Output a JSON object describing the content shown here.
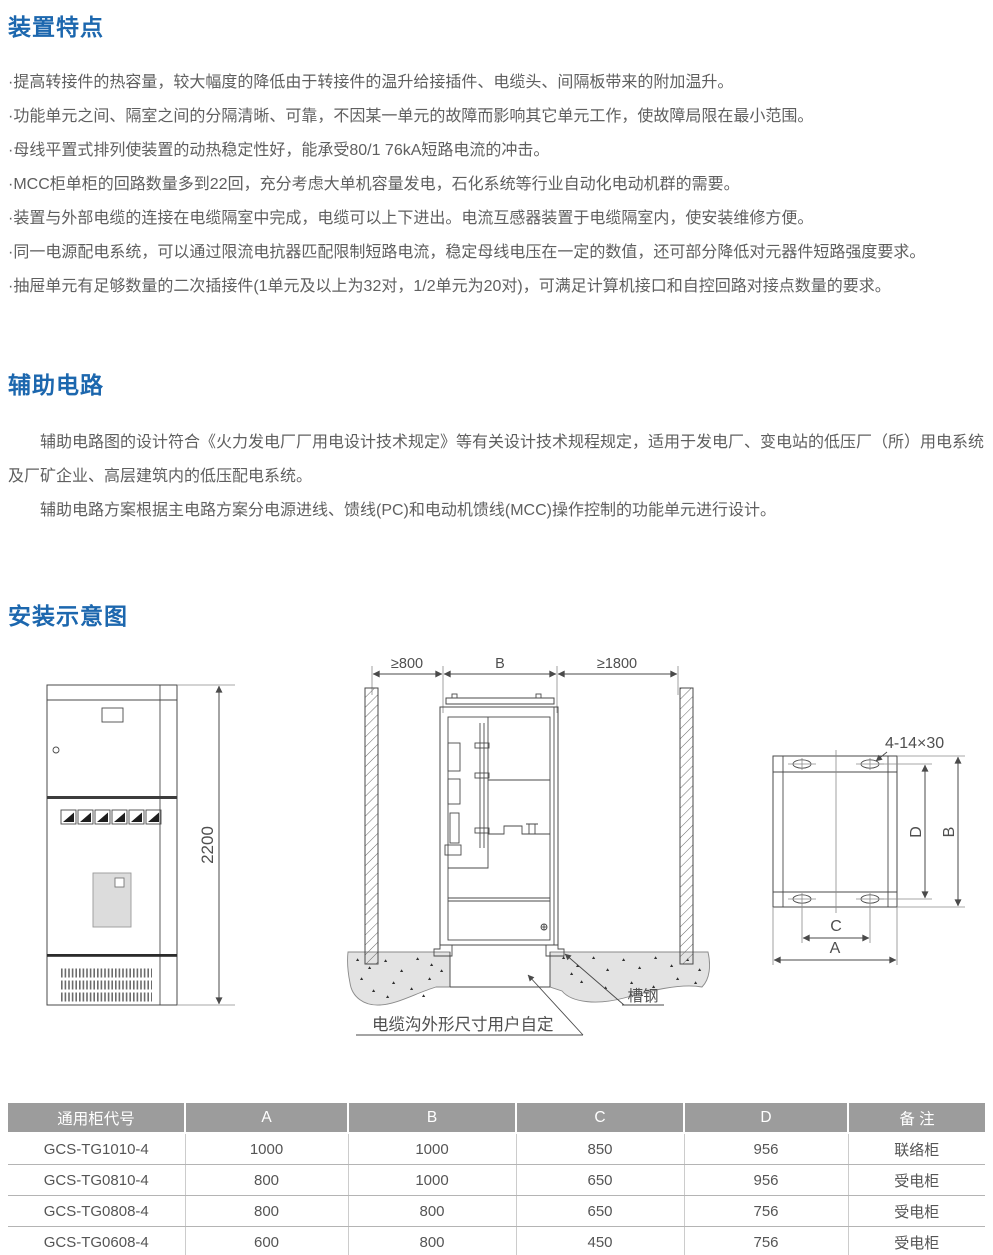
{
  "page": {
    "accent_blue": "#1c67ae",
    "body_text_color": "#5f5f5f",
    "table_header_bg": "#9c9c9c",
    "line_color": "#4a4a4a"
  },
  "sections": {
    "features": {
      "title": "装置特点",
      "items": [
        "·提高转接件的热容量，较大幅度的降低由于转接件的温升给接插件、电缆头、间隔板带来的附加温升。",
        "·功能单元之间、隔室之间的分隔清晰、可靠，不因某一单元的故障而影响其它单元工作，使故障局限在最小范围。",
        "·母线平置式排列使装置的动热稳定性好，能承受80/1 76kA短路电流的冲击。",
        "·MCC柜单柜的回路数量多到22回，充分考虑大单机容量发电，石化系统等行业自动化电动机群的需要。",
        "·装置与外部电缆的连接在电缆隔室中完成，电缆可以上下进出。电流互感器装置于电缆隔室内，使安装维修方便。",
        "·同一电源配电系统，可以通过限流电抗器匹配限制短路电流，稳定母线电压在一定的数值，还可部分降低对元器件短路强度要求。",
        "·抽屉单元有足够数量的二次插接件(1单元及以上为32对，1/2单元为20对)，可满足计算机接口和自控回路对接点数量的要求。"
      ]
    },
    "auxiliary": {
      "title": "辅助电路",
      "paragraphs": [
        "辅助电路图的设计符合《火力发电厂厂用电设计技术规定》等有关设计技术规程规定，适用于发电厂、变电站的低压厂（所）用电系统及厂矿企业、高层建筑内的低压配电系统。",
        "辅助电路方案根据主电路方案分电源进线、馈线(PC)和电动机馈线(MCC)操作控制的功能单元进行设计。"
      ]
    },
    "installation": {
      "title": "安装示意图",
      "front_view": {
        "height_dim": "2200"
      },
      "section_view": {
        "dim_left": "≥800",
        "dim_mid": "B",
        "dim_right": "≥1800",
        "channel_label": "槽钢",
        "trench_label": "电缆沟外形尺寸用户自定"
      },
      "plan_view": {
        "hole_label": "4-14×30",
        "dim_d": "D",
        "dim_b": "B",
        "dim_c": "C",
        "dim_a": "A"
      }
    }
  },
  "table": {
    "headers": [
      "通用柜代号",
      "A",
      "B",
      "C",
      "D",
      "备 注"
    ],
    "rows": [
      [
        "GCS-TG1010-4",
        "1000",
        "1000",
        "850",
        "956",
        "联络柜"
      ],
      [
        "GCS-TG0810-4",
        "800",
        "1000",
        "650",
        "956",
        "受电柜"
      ],
      [
        "GCS-TG0808-4",
        "800",
        "800",
        "650",
        "756",
        "受电柜"
      ],
      [
        "GCS-TG0608-4",
        "600",
        "800",
        "450",
        "756",
        "受电柜"
      ]
    ]
  }
}
